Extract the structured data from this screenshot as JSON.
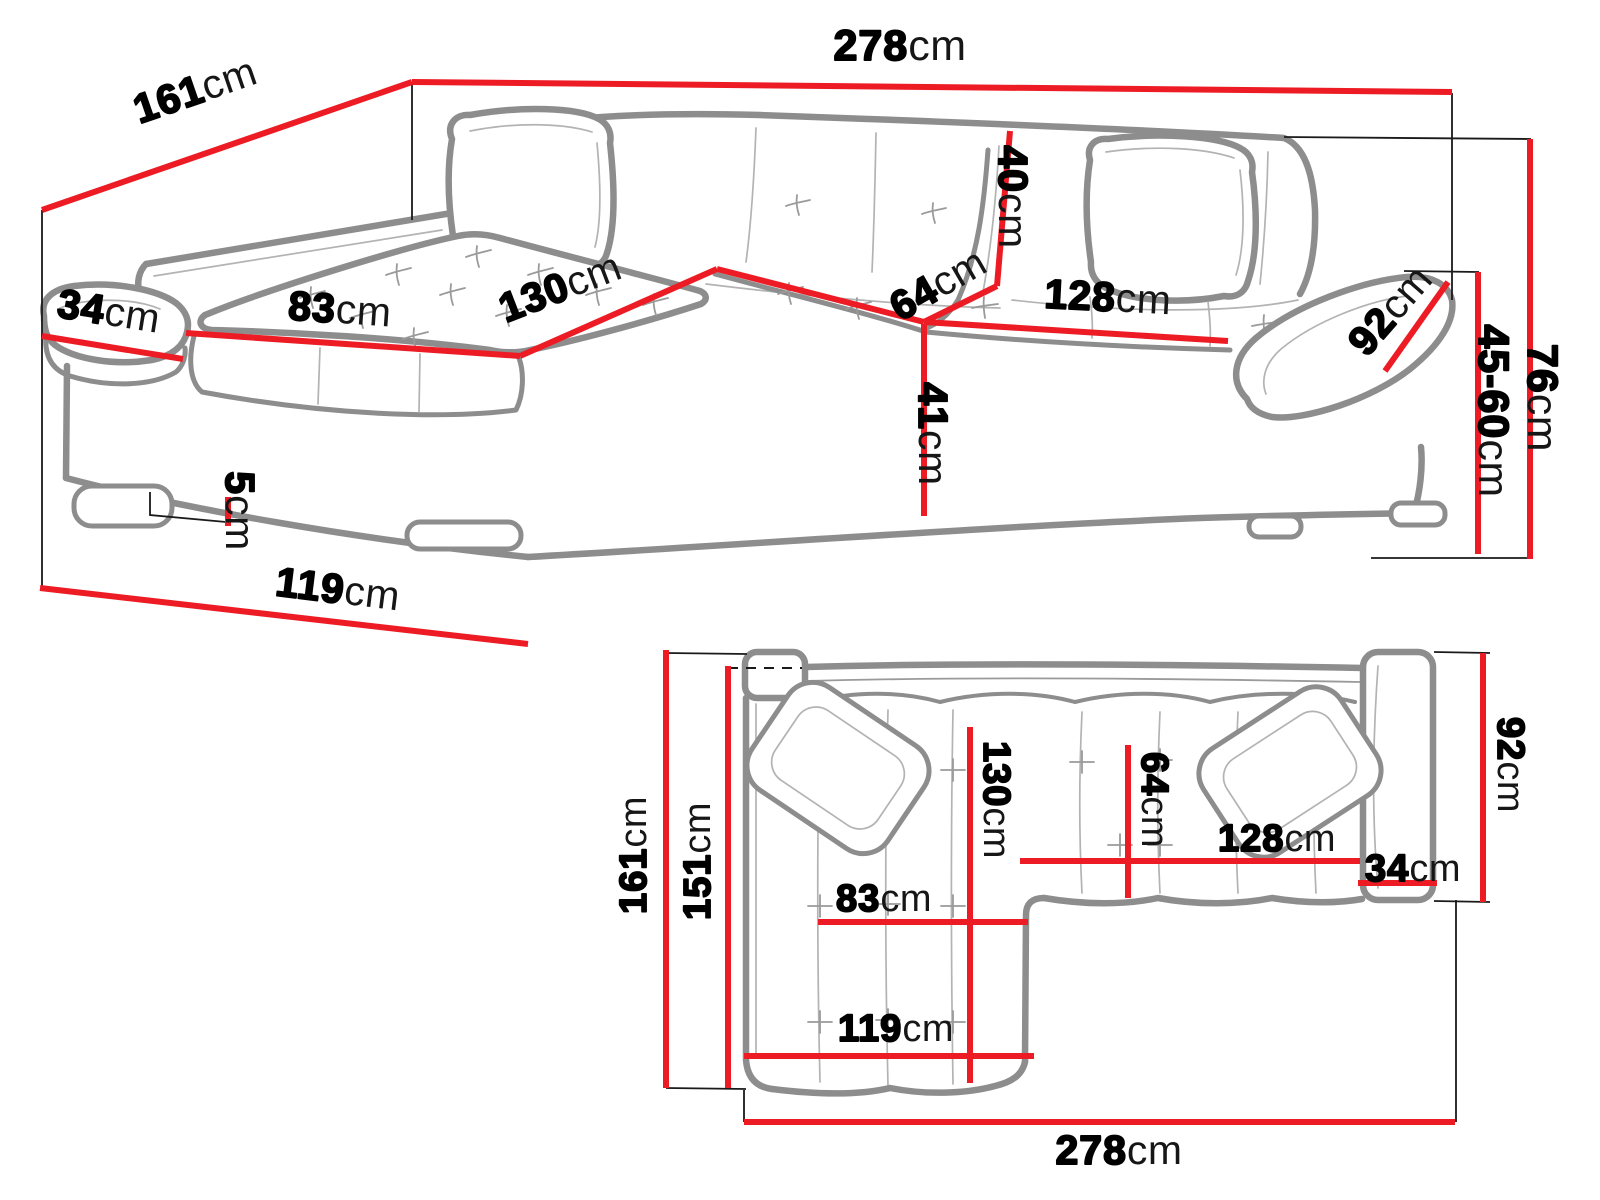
{
  "diagram": {
    "kind": "corner-sofa dimension drawing",
    "unit": "cm",
    "colors": {
      "dimension_line": "#ed1c24",
      "sofa_outline": "#8d8d8d",
      "sofa_detail": "#b3b3b3",
      "extension_line": "#1a1a1a",
      "label_text": "#000000",
      "background": "#ffffff"
    }
  },
  "front_view": {
    "name": "front perspective view",
    "dims": {
      "total_width": {
        "v": "278",
        "u": "cm"
      },
      "total_depth": {
        "v": "161",
        "u": "cm"
      },
      "armrest_width": {
        "v": "34",
        "u": "cm"
      },
      "chaise_seat_width": {
        "v": "83",
        "u": "cm"
      },
      "chaise_seat_length": {
        "v": "130",
        "u": "cm"
      },
      "seat_depth": {
        "v": "64",
        "u": "cm"
      },
      "backrest_height": {
        "v": "40",
        "u": "cm"
      },
      "seat_width": {
        "v": "128",
        "u": "cm"
      },
      "armrest_length": {
        "v": "92",
        "u": "cm"
      },
      "seat_height": {
        "v": "41",
        "u": "cm"
      },
      "leg_height": {
        "v": "5",
        "u": "cm"
      },
      "back_height": {
        "v": "76",
        "u": "cm"
      },
      "seat_height_range": {
        "v": "45-60",
        "u": "cm"
      },
      "chaise_front_depth": {
        "v": "119",
        "u": "cm"
      }
    }
  },
  "plan_view": {
    "name": "top plan view",
    "dims": {
      "total_depth": {
        "v": "161",
        "u": "cm"
      },
      "inner_depth": {
        "v": "151",
        "u": "cm"
      },
      "chaise_length": {
        "v": "130",
        "u": "cm"
      },
      "chaise_seat_width": {
        "v": "83",
        "u": "cm"
      },
      "chaise_front_depth": {
        "v": "119",
        "u": "cm"
      },
      "seat_depth": {
        "v": "64",
        "u": "cm"
      },
      "seat_width": {
        "v": "128",
        "u": "cm"
      },
      "armrest_width": {
        "v": "34",
        "u": "cm"
      },
      "armrest_length": {
        "v": "92",
        "u": "cm"
      },
      "total_width": {
        "v": "278",
        "u": "cm"
      }
    }
  },
  "dimensions_cm": {
    "total_width": 278,
    "total_depth": 161,
    "inner_depth": 151,
    "armrest_width": 34,
    "chaise_seat_width": 83,
    "chaise_seat_length": 130,
    "seat_depth": 64,
    "seat_width": 128,
    "backrest_height": 40,
    "armrest_length": 92,
    "seat_height": 41,
    "leg_height": 5,
    "back_height": 76,
    "seat_height_min": 45,
    "seat_height_max": 60,
    "chaise_front_depth": 119
  }
}
